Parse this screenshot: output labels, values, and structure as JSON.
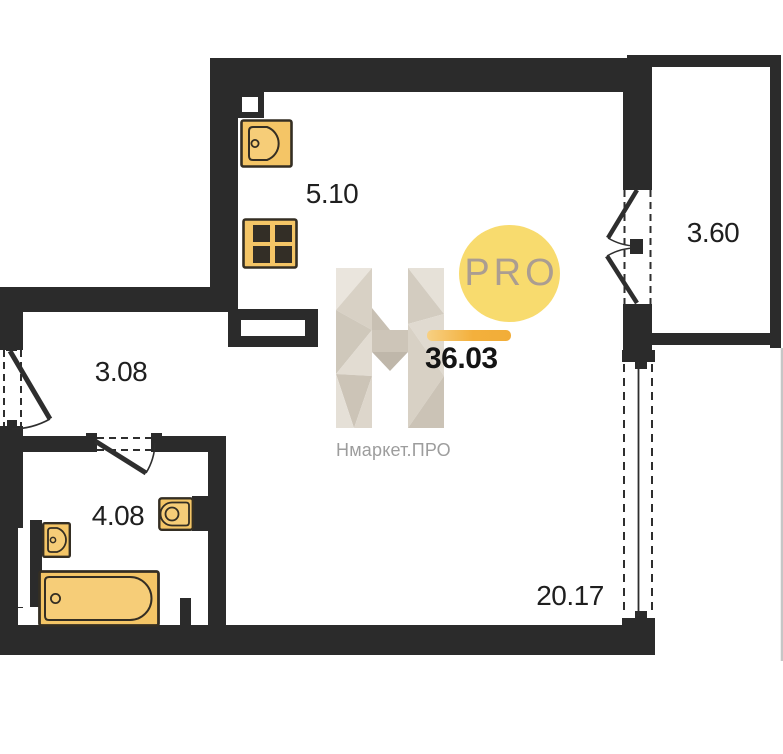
{
  "plan": {
    "rooms": [
      {
        "name": "kitchen",
        "area": "5.10"
      },
      {
        "name": "balcony",
        "area": "3.60"
      },
      {
        "name": "hallway",
        "area": "3.08"
      },
      {
        "name": "bathroom",
        "area": "4.08"
      },
      {
        "name": "living-room",
        "area": "20.17"
      }
    ],
    "total_area": "36.03"
  },
  "watermark": {
    "brand": "Нмаркет.ПРО",
    "badge": "PRO"
  },
  "colors": {
    "wall": "#2b2b2b",
    "fixture_fill": "#f4c566",
    "fixture_stroke": "#342e23",
    "badge_fill": "#f8db6e",
    "badge_text": "#ab9d91",
    "accent_bar": "#f3b03c",
    "label_text": "#1f1f1f",
    "watermark_text": "#9d9d9d"
  }
}
